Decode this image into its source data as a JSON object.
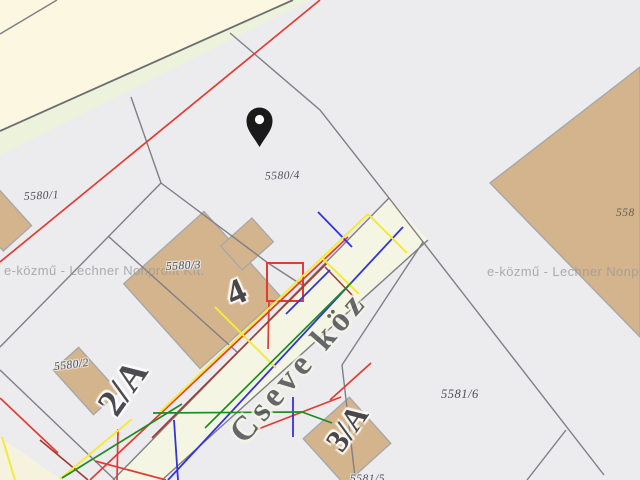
{
  "map": {
    "background_color": "#ececef",
    "road_color": "#fbf7e0",
    "verge_color": "#ecf2dc",
    "street_fill_color": "#f4f6e3",
    "building_color": "#d4b48c",
    "boundary_line_color": "#7f7f84",
    "watermark_left": "e-közmű - Lechner Nonprofit Kft.",
    "watermark_right": "e-közmű - Lechner Nonprofit Kft.",
    "street_name": "Cseve köz",
    "parcel_labels": {
      "p5580_1": "5580/1",
      "p5580_4": "5580/4",
      "p5580_3": "5580/3",
      "p5580_2": "5580/2",
      "p5581_6": "5581/6",
      "p558_partial": "558",
      "p5581_5_partial": "5581/5"
    },
    "house_numbers": {
      "h4": "4",
      "h2a": "2/A",
      "h3a": "3/A"
    },
    "utility_colors": {
      "red": "#e23b33",
      "dark_red": "#a03a33",
      "blue": "#3333dd",
      "yellow": "#f4ea39",
      "green": "#1e8c1e"
    },
    "marker": {
      "icon": "location-pin",
      "color": "#1a1a1a"
    }
  }
}
